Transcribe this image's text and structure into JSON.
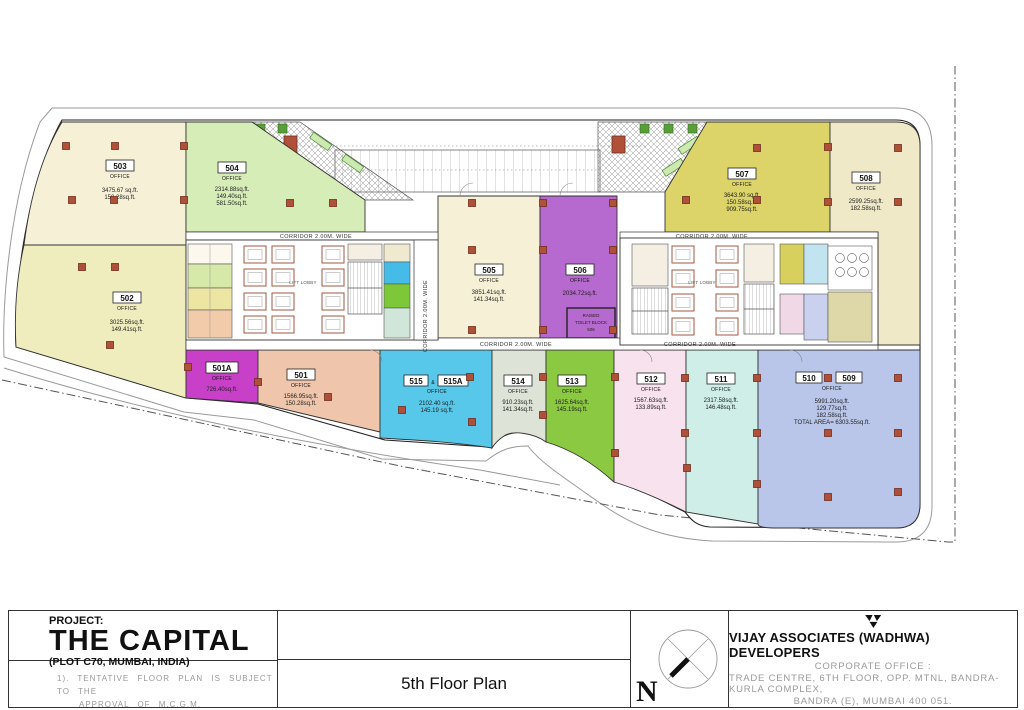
{
  "units": [
    {
      "number": "503",
      "type": "OFFICE",
      "areas": [
        "3475.67 sq.ft.",
        "150.28sq.ft."
      ]
    },
    {
      "number": "502",
      "type": "OFFICE",
      "areas": [
        "3025.56sq.ft.",
        "149.41sq.ft."
      ]
    },
    {
      "number": "504",
      "type": "OFFICE",
      "areas": [
        "2314.88sq.ft.",
        "149.40sq.ft.",
        "581.50sq.ft."
      ]
    },
    {
      "number": "505",
      "type": "OFFICE",
      "areas": [
        "3851.41sq.ft.",
        "141.34sq.ft."
      ]
    },
    {
      "number": "506",
      "type": "OFFICE",
      "areas": [
        "2034.72sq.ft."
      ]
    },
    {
      "number": "507",
      "type": "OFFICE",
      "areas": [
        "3643.90 sq.ft.",
        "150.58sq.ft.",
        "909.75sq.ft."
      ]
    },
    {
      "number": "508",
      "type": "OFFICE",
      "areas": [
        "2599.25sq.ft.",
        "182.58sq.ft."
      ]
    },
    {
      "number": "501A",
      "type": "OFFICE",
      "areas": [
        "726.40sq.ft."
      ]
    },
    {
      "number": "501",
      "type": "OFFICE",
      "areas": [
        "1566.95sq.ft.",
        "150.28sq.ft."
      ]
    },
    {
      "number": "515",
      "amp": "&",
      "number2": "515A",
      "type": "OFFICE",
      "areas": [
        "2102.40 sq.ft.",
        "145.19 sq.ft."
      ]
    },
    {
      "number": "514",
      "type": "OFFICE",
      "areas": [
        "910.23sq.ft.",
        "141.34sq.ft."
      ]
    },
    {
      "number": "513",
      "type": "OFFICE",
      "areas": [
        "1625.64sq.ft.",
        "145.19sq.ft."
      ]
    },
    {
      "number": "512",
      "type": "OFFICE",
      "areas": [
        "1567.63sq.ft.",
        "133.89sq.ft."
      ]
    },
    {
      "number": "511",
      "type": "OFFICE",
      "areas": [
        "2317.58sq.ft.",
        "146.48sq.ft."
      ]
    },
    {
      "number": "510",
      "amp": "&",
      "number2": "509",
      "type": "OFFICE",
      "areas": [
        "5991.20sq.ft.",
        "129.77sq.ft.",
        "182.58sq.ft.",
        "TOTAL AREA= 6303.55sq.ft."
      ]
    }
  ],
  "labels": {
    "corridor": "CORRIDOR 2.00M. WIDE",
    "lift_lobby": "LIFT LOBBY",
    "raised_toilet": [
      "RAISED",
      "TOILET BLOCK",
      "506"
    ]
  },
  "title_block": {
    "project_label": "PROJECT:",
    "project_name": "THE CAPITAL",
    "project_location": "(PLOT C70, MUMBAI, INDIA)",
    "note_line1": "1). TENTATIVE FLOOR PLAN IS SUBJECT TO THE",
    "note_line2": "APPROVAL OF M.C.G.M.",
    "sheet_title": "5th Floor Plan",
    "compass_letter": "N",
    "developer": "VIJAY ASSOCIATES (WADHWA) DEVELOPERS",
    "office_label": "CORPORATE OFFICE :",
    "address1": "TRADE CENTRE, 6TH FLOOR, OPP. MTNL, BANDRA-KURLA COMPLEX,",
    "address2": "BANDRA (E), MUMBAI 400 051."
  },
  "colors": {
    "u503": "#f6f1d6",
    "u502": "#efedbe",
    "u504": "#d7edb8",
    "u505": "#f6f1d6",
    "u506": "#b669ce",
    "u507": "#dcd468",
    "u508": "#efe9c8",
    "u501A": "#c840c8",
    "u501": "#efc6ab",
    "u515": "#57c8ea",
    "u514": "#dde3d6",
    "u513": "#8bc943",
    "u512": "#f8e2ee",
    "u511": "#cfeee7",
    "u510": "#bac6e9",
    "column": "#b05038",
    "wall": "#a05a40"
  }
}
